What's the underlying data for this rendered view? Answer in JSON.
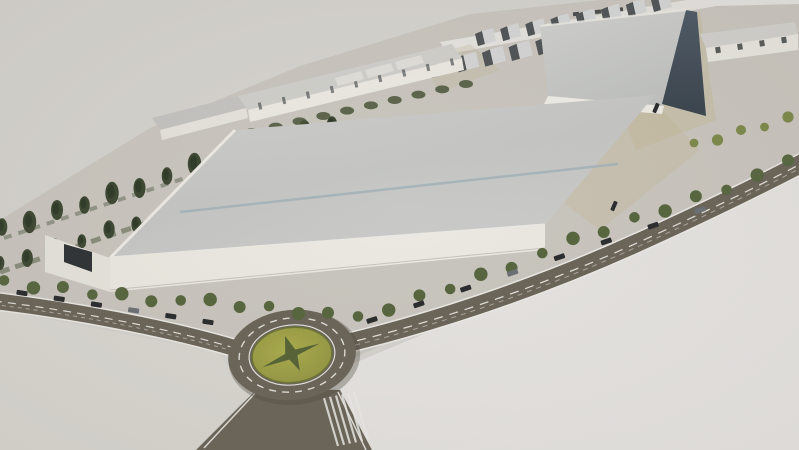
{
  "scene": {
    "kind": "architectural-site-rendering",
    "groups": {
      "windows_top": {
        "type": "window",
        "from": [
          576,
          14
        ],
        "to": [
          664,
          5
        ],
        "count": 5,
        "w": 6,
        "h": 4,
        "fill": "car_dark",
        "o": 0.8
      },
      "units_upper": {
        "type": "unit",
        "from": [
          478,
          46
        ],
        "to": [
          654,
          12
        ],
        "count": 8
      },
      "units_lower": {
        "type": "unit",
        "from": [
          432,
          78
        ],
        "to": [
          592,
          44
        ],
        "count": 7,
        "s": 1.15
      },
      "top_trees": {
        "type": "tree",
        "from": [
          554,
          76
        ],
        "to": [
          644,
          24
        ],
        "count": 5,
        "rx": 6,
        "ry": 5,
        "fill": "tree_olive",
        "j": 1
      },
      "wall_ticks": {
        "type": "tick",
        "from": [
          260,
          106
        ],
        "to": [
          452,
          62
        ],
        "count": 9,
        "w": 3,
        "h": 7,
        "fill": "unit_dark",
        "o": 0.7
      },
      "nw_trees_upper": {
        "type": "tree",
        "from": [
          2,
          230
        ],
        "to": [
          332,
          122
        ],
        "count": 13,
        "rx": 6,
        "ry": 10,
        "fill": "tree_dark",
        "core": true,
        "j": 1
      },
      "nw_trees_lower": {
        "type": "tree",
        "from": [
          0,
          266
        ],
        "to": [
          300,
          168
        ],
        "count": 12,
        "rx": 5,
        "ry": 8,
        "fill": "tree_dark",
        "core": true,
        "j": 1
      },
      "hedge_blobs": {
        "type": "blob",
        "from": [
          252,
          132
        ],
        "to": [
          466,
          84
        ],
        "count": 10,
        "rx": 7,
        "ry": 4,
        "fill": "hedge_dark",
        "o": 0.85
      },
      "windows_east": {
        "type": "window",
        "from": [
          718,
          50
        ],
        "to": [
          784,
          40
        ],
        "count": 4,
        "w": 5,
        "h": 6,
        "fill": "car_dark",
        "o": 0.75
      },
      "hatch_lines": {
        "type": "hatch",
        "from": [
          324,
          398
        ],
        "to": [
          354,
          392
        ],
        "count": 6,
        "dx": 14,
        "dy": 48,
        "w": 2.2,
        "fill": "marking",
        "o": 0.85
      },
      "approach_trees": {
        "type": "tree",
        "from": [
          4,
          284
        ],
        "to": [
          328,
          314
        ],
        "count": 12,
        "rx": 6,
        "ry": 6,
        "fill": "tree_mid",
        "j": 1.2
      },
      "approach_cars": {
        "type": "car",
        "from": [
          22,
          293
        ],
        "to": [
          208,
          322
        ],
        "count": 6,
        "w": 11,
        "h": 5,
        "fill": "car_dark"
      },
      "main_road_trees": {
        "type": "tree",
        "from": [
          358,
          320
        ],
        "to": [
          788,
          164
        ],
        "count": 15,
        "rx": 6,
        "ry": 6,
        "fill": "tree_mid",
        "j": 1.2
      },
      "main_road_cars": {
        "type": "car",
        "from": [
          372,
          320
        ],
        "to": [
          700,
          210
        ],
        "count": 8,
        "w": 11,
        "h": 5,
        "fill": "car_dark"
      },
      "yard_trees": {
        "type": "tree",
        "from": [
          694,
          146
        ],
        "to": [
          788,
          118
        ],
        "count": 5,
        "rx": 5,
        "ry": 5,
        "fill": "tree_olive",
        "j": 1
      },
      "scatter_cars": {
        "type": "car",
        "from": [
          614,
          206
        ],
        "to": [
          656,
          108
        ],
        "count": 2,
        "w": 10,
        "h": 4,
        "fill": "car_dark"
      }
    }
  },
  "palette": {
    "paper": "#d8d5d0",
    "paper_bright": "#e9e7e3",
    "ground": "#ccc8c0",
    "pavement": "#dcd9d3",
    "asphalt": "#6b6356",
    "asphalt_dark": "#4e473c",
    "marking": "#efeeea",
    "roof_light": "#cbcbc9",
    "roof_shade": "#c0c1bf",
    "ridge_blue": "#a2b4bd",
    "wall_white": "#efece4",
    "gable_white": "#eae7df",
    "fascia_white": "#f2efe8",
    "dark_face": "#45525f",
    "dark_face_deep": "#37424d",
    "unit_dark": "#4e5356",
    "unit_light": "#d7d8d9",
    "building_roof": "#d2d1cd",
    "tree_dark": "#39462e",
    "tree_core": "#2c3824",
    "tree_mid": "#55663a",
    "tree_olive": "#7d8a45",
    "hedge_dark": "#465434",
    "island_green": "#a3a23e",
    "island_edge": "#6d7430",
    "star_green": "#4b5c2e",
    "car_dark": "#26292b",
    "car_light": "#6a7076",
    "tan": "#c8bb94",
    "door_dark": "#2b3033",
    "strip_white": "#e8e6e1"
  }
}
